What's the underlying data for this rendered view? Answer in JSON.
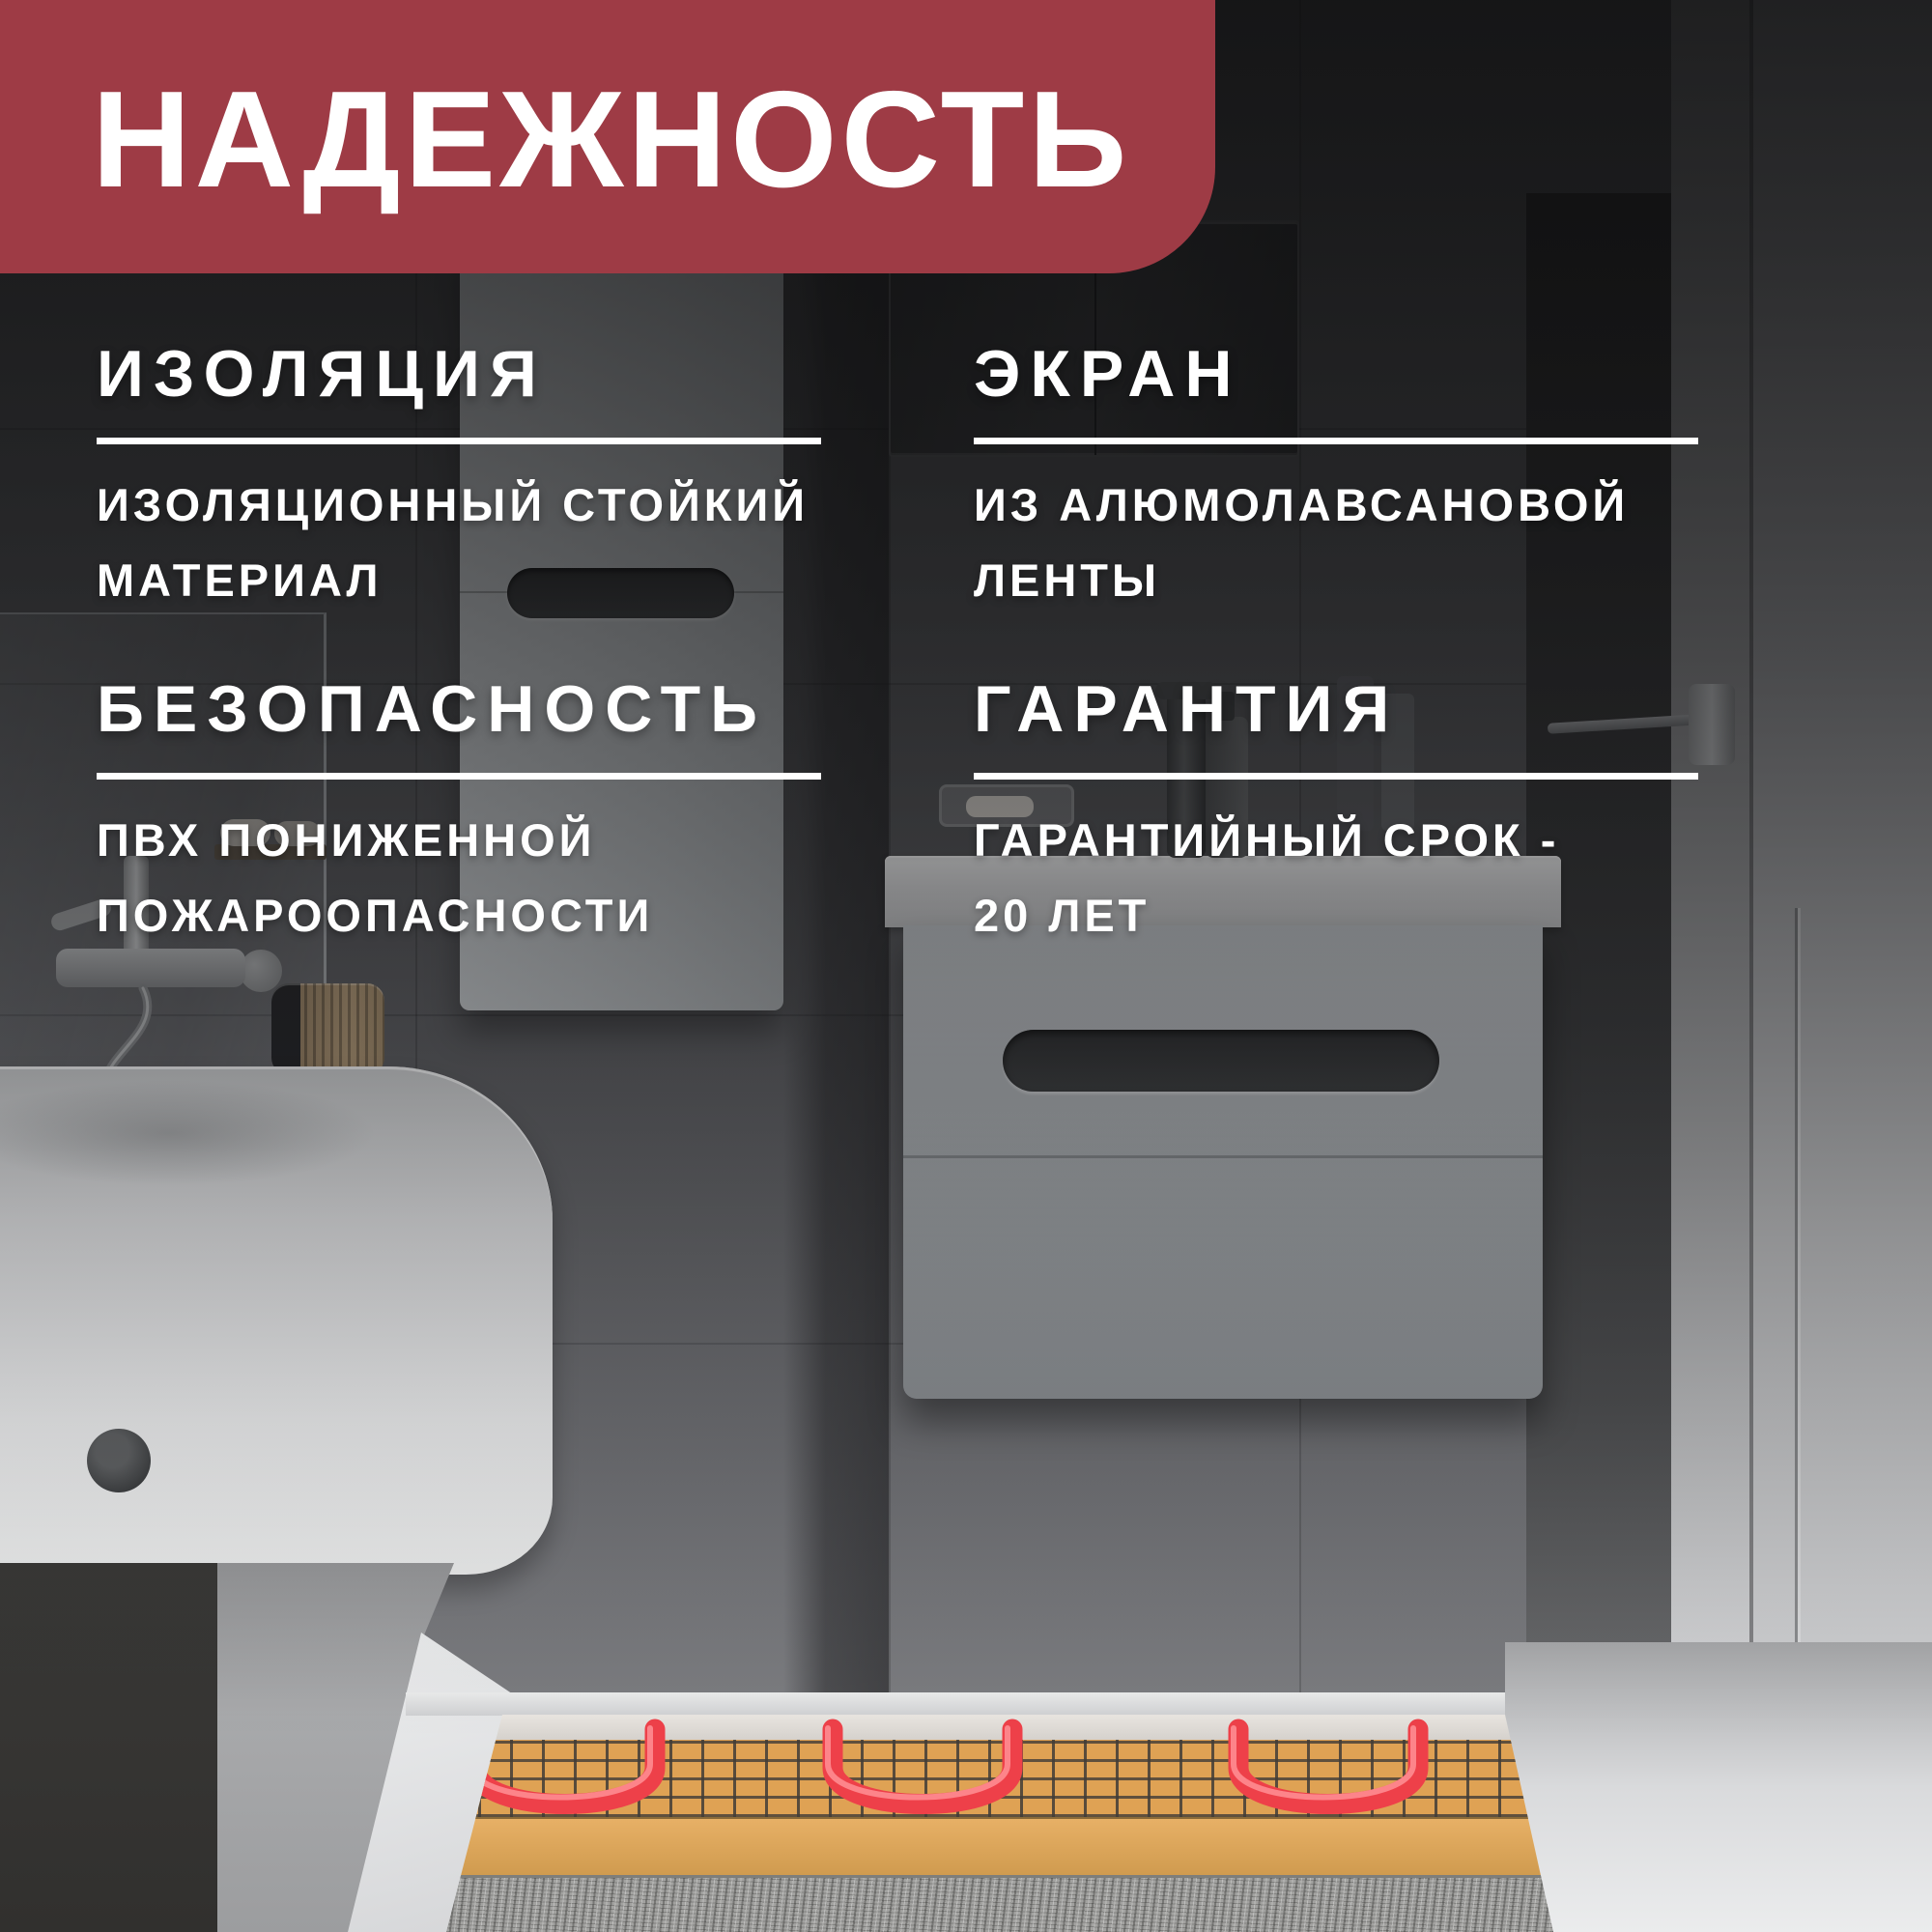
{
  "badge": {
    "title": "НАДЕЖНОСТЬ"
  },
  "features": [
    {
      "id": "insulation",
      "title": "ИЗОЛЯЦИЯ",
      "description_lines": [
        "ИЗОЛЯЦИОННЫЙ СТОЙКИЙ",
        "МАТЕРИАЛ"
      ]
    },
    {
      "id": "screen",
      "title": "ЭКРАН",
      "description_lines": [
        "ИЗ АЛЮМОЛАВСАНОВОЙ",
        "ЛЕНТЫ"
      ]
    },
    {
      "id": "safety",
      "title": "БЕЗОПАСНОСТЬ",
      "description_lines": [
        "ПВХ ПОНИЖЕННОЙ",
        "ПОЖАРООПАСНОСТИ"
      ]
    },
    {
      "id": "warranty",
      "title": "ГАРАНТИЯ",
      "description_lines": [
        "ГАРАНТИЙНЫЙ СРОК -",
        "20 ЛЕТ"
      ]
    }
  ],
  "colors": {
    "badge_bg": "#9e3b45",
    "text": "#ffffff",
    "underline": "#ffffff",
    "heating_mat_orange": "#dfa254",
    "heating_cable_red": "#ee4049",
    "mesh_grid": "#59554e"
  }
}
